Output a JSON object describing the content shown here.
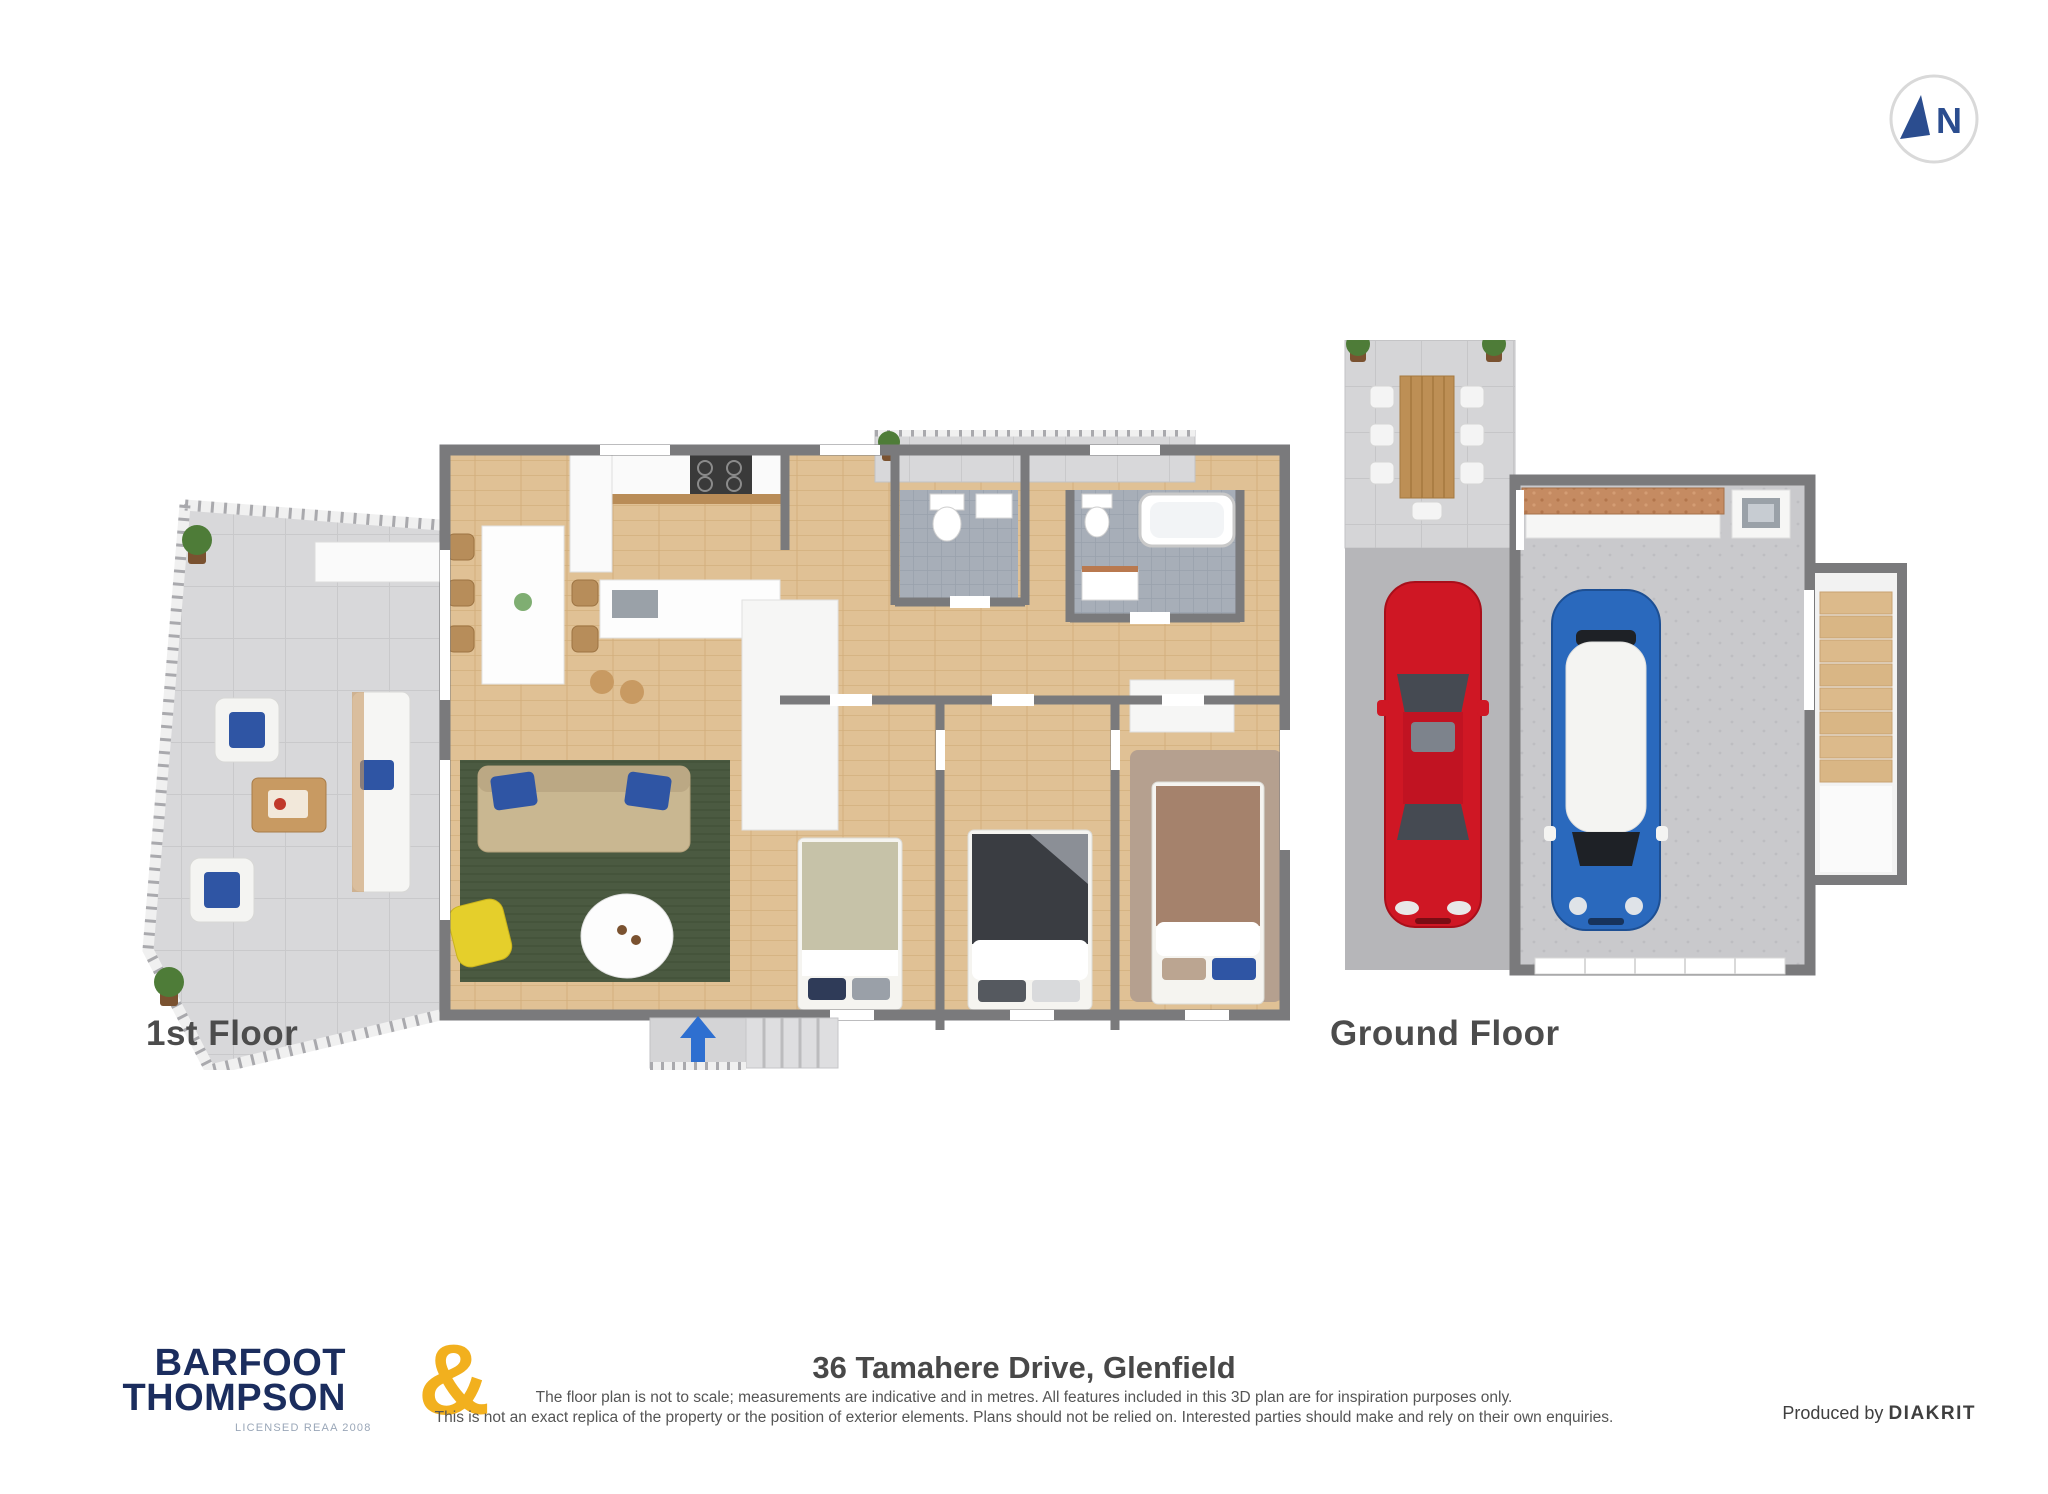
{
  "compass": {
    "label": "N"
  },
  "plans": {
    "first": {
      "label": "1st Floor"
    },
    "ground": {
      "label": "Ground Floor"
    }
  },
  "footer": {
    "address": "36 Tamahere Drive, Glenfield",
    "disclaimer_line1": "The floor plan is not to scale; measurements are indicative and in metres. All features included in this 3D plan are for inspiration purposes only.",
    "disclaimer_line2": "This is not an exact replica of the property or the position of exterior elements. Plans should not be relied on. Interested parties should make and rely on their own enquiries.",
    "produced_by": "Produced by",
    "producer": "DIAKRIT"
  },
  "logo": {
    "line1": "BARFOOT",
    "line2": "THOMPSON",
    "ampersand": "&",
    "license": "LICENSED REAA 2008"
  },
  "colors": {
    "stair_arrow_blue": "#2e6fd0",
    "compass_navy": "#2b4d8f",
    "logo_navy": "#1b2d5e",
    "logo_gold": "#f2b01e",
    "red_car": "#cf1724",
    "blue_car": "#2a69bd",
    "rug_green": "#4b5a41",
    "sofa_beige": "#c9b791",
    "cushion_blue": "#2f55a4",
    "armchair_yellow": "#e5cf2b",
    "wood_floor": "#e0c195",
    "terrace_tile_gray": "#d8d8da",
    "bathroom_tile_gray": "#a7aeb8",
    "wall_gray": "#7a7a7c",
    "master_bed_brown": "#a5826c",
    "guest_bed_dark": "#3a3d42"
  }
}
